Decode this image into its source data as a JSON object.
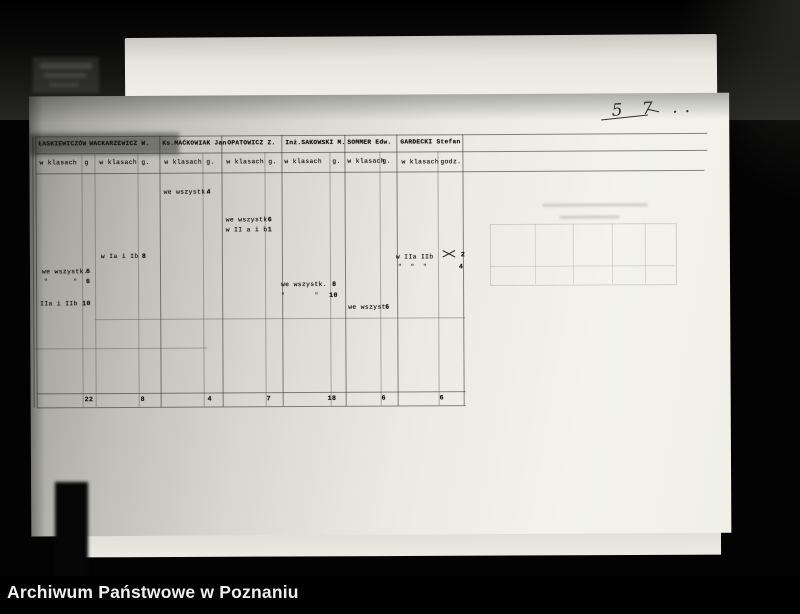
{
  "footer": {
    "caption": "Archiwum Państwowe w Poznaniu"
  },
  "handwriting": {
    "page_number": "5 7 .."
  },
  "stamp": {
    "corner_label": "Dok."
  },
  "table": {
    "teachers": [
      {
        "name": "ŁASKIEWICZÓW",
        "class_header": "w klasach",
        "hours_header": "g"
      },
      {
        "name": "WACKARZEWICZ W.",
        "class_header": "w klasach",
        "hours_header": "g."
      },
      {
        "name": "Ks.MAĆKOWIAK Jan",
        "class_header": "w klasach",
        "hours_header": "g."
      },
      {
        "name": "OPATOWICZ Z.",
        "class_header": "w klasach",
        "hours_header": "g."
      },
      {
        "name": "Inż.SAKOWSKI M.",
        "class_header": "w klasach",
        "hours_header": "g."
      },
      {
        "name": "SOMMER Edw.",
        "class_header": "w klasach",
        "hours_header": "g."
      },
      {
        "name": "GARDECKI Stefan",
        "class_header": "w klasach",
        "hours_header": "godz."
      }
    ],
    "entries": {
      "laskiewicz_1": {
        "classes": "we wszystk.",
        "hours": "6"
      },
      "laskiewicz_2": {
        "classes": "\"      \"",
        "hours": "6"
      },
      "laskiewicz_3": {
        "classes": "IIa i IIb",
        "hours": "10"
      },
      "wackarzewicz_1": {
        "classes": "w Ia i Ib",
        "hours": "8"
      },
      "mackowiak_1": {
        "classes": "we wszystk.",
        "hours": "4"
      },
      "opatowicz_1": {
        "classes": "we wszystk.",
        "hours": "6"
      },
      "opatowicz_2": {
        "classes": "w II a i b",
        "hours": "1"
      },
      "sakowski_1": {
        "classes": "we wszystk.",
        "hours": "8"
      },
      "sakowski_2": {
        "classes": "\"       \"",
        "hours": "10"
      },
      "sommer_1": {
        "classes": "we wszyst.",
        "hours": "6"
      },
      "gardecki_1": {
        "classes": "w IIa IIb",
        "hours": "2"
      },
      "gardecki_2": {
        "classes": "\"  \"  \"",
        "hours": "4"
      }
    },
    "totals": [
      "22",
      "8",
      "4",
      "7",
      "18",
      "6",
      "6"
    ]
  }
}
